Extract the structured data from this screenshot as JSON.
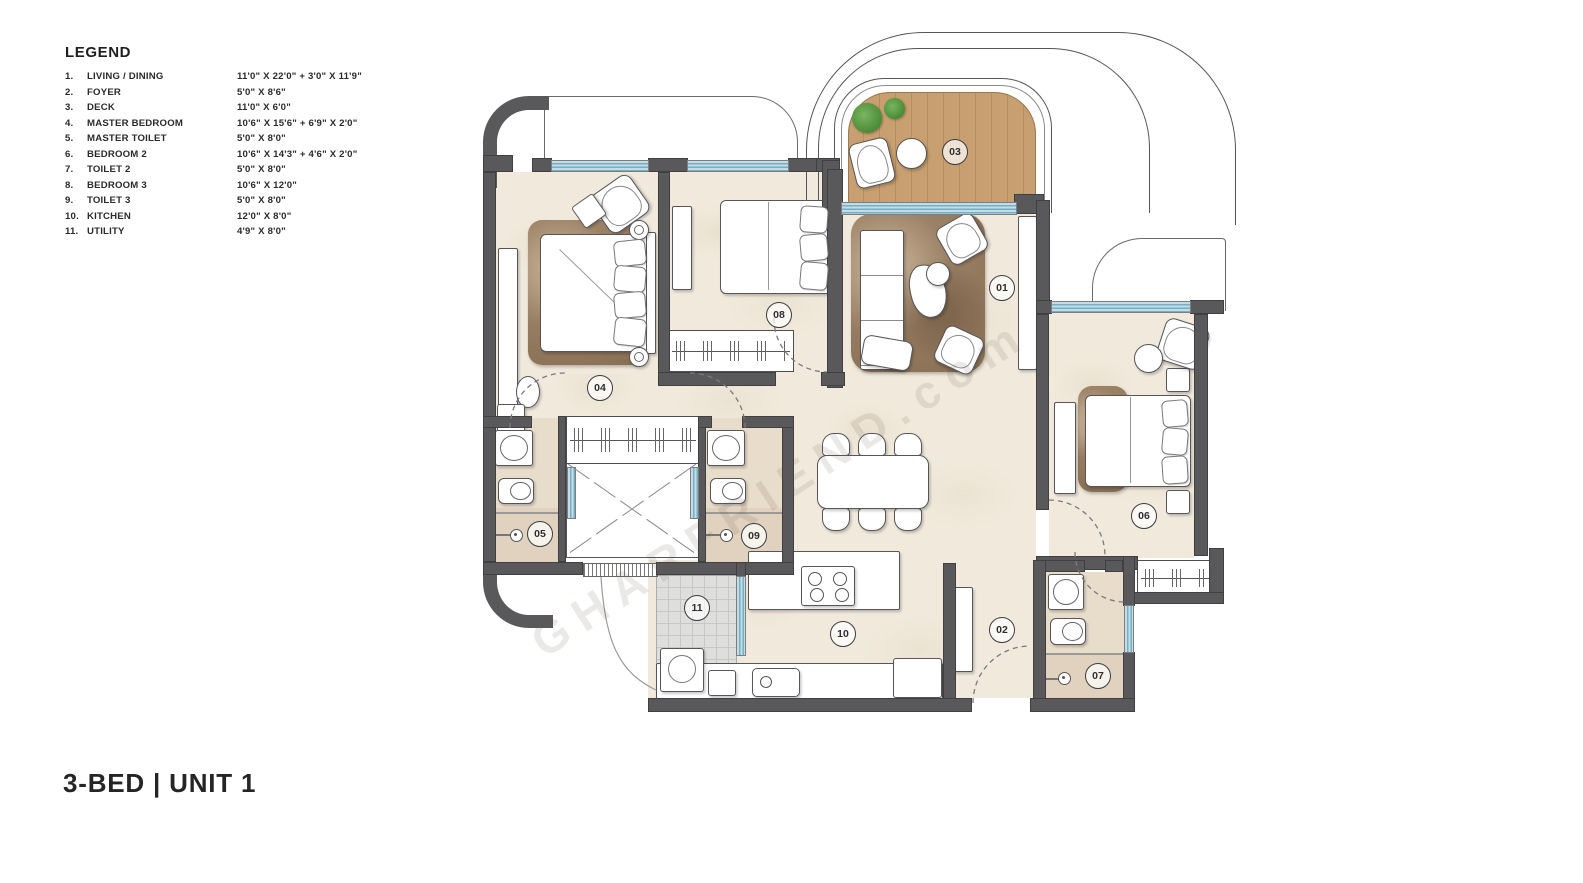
{
  "legend": {
    "title": "LEGEND",
    "items": [
      {
        "num": "1.",
        "name": "LIVING / DINING",
        "dim": "11'0\" X 22'0\" + 3'0\" X 11'9\""
      },
      {
        "num": "2.",
        "name": "FOYER",
        "dim": "5'0\" X 8'6\""
      },
      {
        "num": "3.",
        "name": "DECK",
        "dim": "11'0\" X 6'0\""
      },
      {
        "num": "4.",
        "name": "MASTER BEDROOM",
        "dim": "10'6\" X 15'6\" + 6'9\" X 2'0\""
      },
      {
        "num": "5.",
        "name": "MASTER TOILET",
        "dim": "5'0\" X 8'0\""
      },
      {
        "num": "6.",
        "name": "BEDROOM 2",
        "dim": "10'6\" X 14'3\" + 4'6\" X 2'0\""
      },
      {
        "num": "7.",
        "name": "TOILET 2",
        "dim": "5'0\" X 8'0\""
      },
      {
        "num": "8.",
        "name": "BEDROOM 3",
        "dim": "10'6\" X 12'0\""
      },
      {
        "num": "9.",
        "name": "TOILET 3",
        "dim": "5'0\" X 8'0\""
      },
      {
        "num": "10.",
        "name": "KITCHEN",
        "dim": "12'0\" X 8'0\""
      },
      {
        "num": "11.",
        "name": "UTILITY",
        "dim": "4'9\" X 8'0\""
      }
    ]
  },
  "plan": {
    "title": "3-BED | UNIT 1",
    "watermark": "GHARFRIEND.com",
    "room_labels": [
      {
        "id": "01",
        "x": 1002,
        "y": 288
      },
      {
        "id": "02",
        "x": 1002,
        "y": 630
      },
      {
        "id": "03",
        "x": 955,
        "y": 152
      },
      {
        "id": "04",
        "x": 600,
        "y": 388
      },
      {
        "id": "05",
        "x": 540,
        "y": 534
      },
      {
        "id": "06",
        "x": 1144,
        "y": 516
      },
      {
        "id": "07",
        "x": 1098,
        "y": 676
      },
      {
        "id": "08",
        "x": 779,
        "y": 315
      },
      {
        "id": "09",
        "x": 754,
        "y": 536
      },
      {
        "id": "10",
        "x": 843,
        "y": 634
      },
      {
        "id": "11",
        "x": 697,
        "y": 608
      }
    ]
  },
  "colors": {
    "wall": "#59595b",
    "floor": "#f1eadc",
    "toilet_floor": "#e8dccb",
    "window_blue": "#76aec3",
    "deck_wood": "#c49a6c",
    "plant_green": "#5c9247"
  }
}
